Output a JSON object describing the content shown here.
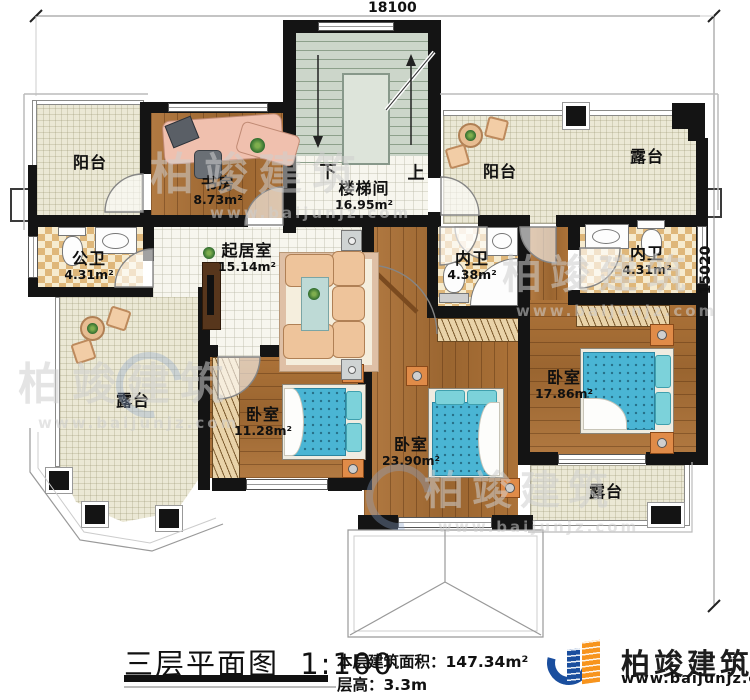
{
  "dimensions": {
    "width": "18100",
    "height": "15020"
  },
  "rooms": [
    {
      "id": "study",
      "name": "书房",
      "area": "8.73m²"
    },
    {
      "id": "stairwell",
      "name": "楼梯间",
      "area": "16.95m²"
    },
    {
      "id": "balcony-top-left",
      "name": "阳台",
      "area": ""
    },
    {
      "id": "balcony-top-right",
      "name": "阳台",
      "area": ""
    },
    {
      "id": "terrace-top-right",
      "name": "露台",
      "area": ""
    },
    {
      "id": "public-bath",
      "name": "公卫",
      "area": "4.31m²"
    },
    {
      "id": "living-room",
      "name": "起居室",
      "area": "15.14m²"
    },
    {
      "id": "ensuite-bath-a",
      "name": "内卫",
      "area": "4.38m²"
    },
    {
      "id": "ensuite-bath-b",
      "name": "内卫",
      "area": "4.31m²"
    },
    {
      "id": "bedroom-right",
      "name": "卧室",
      "area": "17.86m²"
    },
    {
      "id": "terrace-left",
      "name": "露台",
      "area": ""
    },
    {
      "id": "bedroom-left",
      "name": "卧室",
      "area": "11.28m²"
    },
    {
      "id": "bedroom-bottom",
      "name": "卧室",
      "area": "23.90m²"
    },
    {
      "id": "terrace-bottom-right",
      "name": "露台",
      "area": ""
    }
  ],
  "stairs": {
    "down": "下",
    "up": "上"
  },
  "footer": {
    "title": "三层平面图",
    "scale": "1:100",
    "area_label": "本层建筑面积：",
    "area_value": "147.34m²",
    "height_label": "层高：",
    "height_value": "3.3m"
  },
  "branding": {
    "company": "柏竣建筑",
    "website": "www.baijunjz.com"
  },
  "watermark": {
    "text": "柏竣建筑",
    "url": "www.baijunjz.com"
  },
  "colors": {
    "wall": "#141414",
    "wood": "#a8703a",
    "tile_cream": "#ebe8d5",
    "checker_tan": "#dfb77a",
    "bed_blue": "#4ab5d4",
    "logo_blue": "#1a4e9e",
    "logo_orange": "#f7941d"
  }
}
